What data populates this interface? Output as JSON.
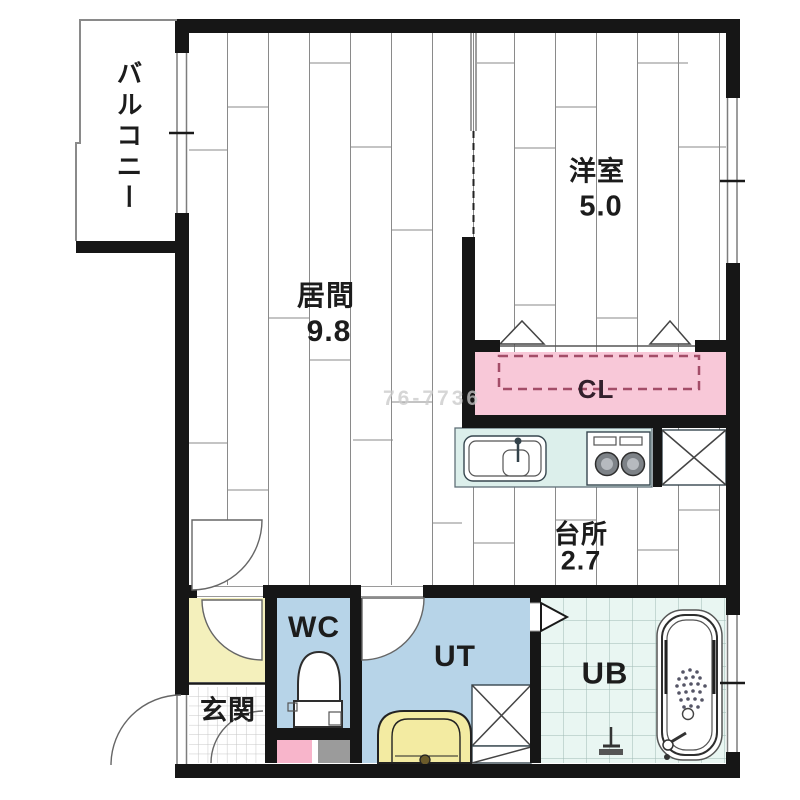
{
  "watermark": {
    "text": "76-7736"
  },
  "rooms": {
    "balcony": {
      "label": "バルコニー"
    },
    "living": {
      "label": "居間",
      "size": "9.8"
    },
    "western_room": {
      "label": "洋室",
      "size": "5.0"
    },
    "closet": {
      "label": "CL"
    },
    "kitchen": {
      "label": "台所",
      "size": "2.7"
    },
    "toilet": {
      "label": "WC"
    },
    "utility": {
      "label": "UT"
    },
    "bath": {
      "label": "UB"
    },
    "entrance": {
      "label": "玄関"
    }
  },
  "colors": {
    "wall": "#161616",
    "closet_pink": "#f8c8d8",
    "hall_yellow": "#f4f0bc",
    "wet_blue": "#b7d4e8",
    "bath_tint": "#e9f6f2",
    "counter_cyan": "#dcefeb",
    "dash_accent": "#a34d68",
    "gray_box": "#9b9b9b",
    "pink_box": "#f8b5cb",
    "basin_yellow": "#f3eba2"
  }
}
